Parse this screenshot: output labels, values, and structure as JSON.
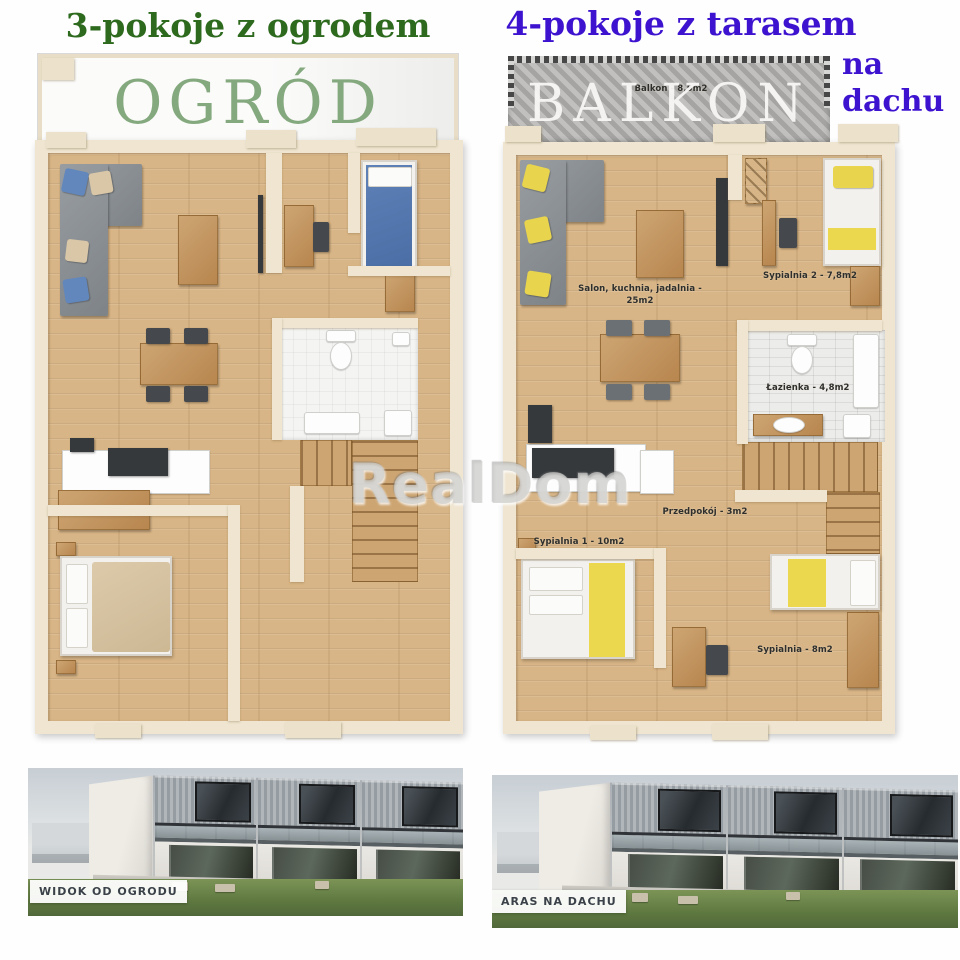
{
  "left_plan": {
    "title": "3-pokoje z ogrodem",
    "garden_label": "OGRÓD"
  },
  "right_plan": {
    "title": "4-pokoje z tarasem",
    "subtitle": [
      "na",
      "dachu"
    ],
    "balcony_label": "BALKON",
    "balcony_area_label": "Balkon - 8,5m2",
    "rooms": [
      {
        "name": "living-kitchen-dining",
        "label": "Salon, kuchnia, jadalnia - 25m2"
      },
      {
        "name": "bedroom-2",
        "label": "Sypialnia 2 - 7,8m2"
      },
      {
        "name": "bathroom",
        "label": "Łazienka - 4,8m2"
      },
      {
        "name": "hallway",
        "label": "Przedpokój - 3m2"
      },
      {
        "name": "bedroom-1",
        "label": "Sypialnia 1 - 10m2"
      },
      {
        "name": "bedroom-small",
        "label": "Sypialnia - 8m2"
      }
    ]
  },
  "watermark": "RealDom",
  "photos": [
    {
      "caption": "WIDOK OD OGRODU"
    },
    {
      "caption": "ARAS NA DACHU"
    }
  ],
  "colors": {
    "left_title_green": "#2d6a1e",
    "garden_text_green": "#85a97e",
    "right_title_purple": "#3e13d0",
    "balcony_text_white": "#f5f4f2",
    "accent_yellow": "#e8d44d",
    "accent_blue": "#6287bd",
    "wall_cream": "#efe5d0",
    "wood_floor": "#d8b586"
  }
}
